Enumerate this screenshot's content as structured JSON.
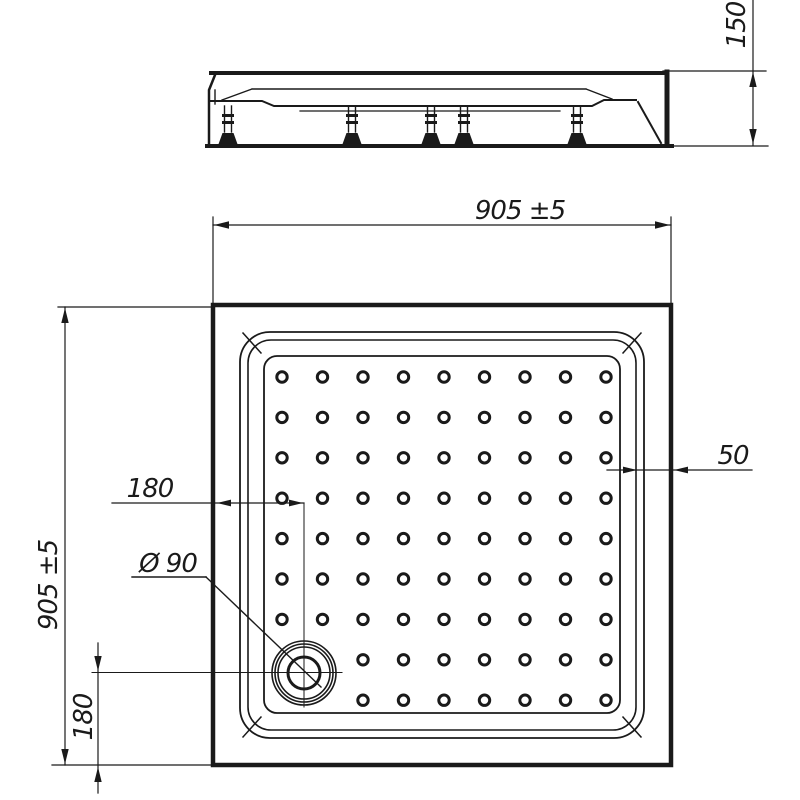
{
  "document": {
    "type": "technical-drawing",
    "subject": "square shower tray with adjustable feet",
    "background": "#ffffff",
    "line_color": "#1a1a1a"
  },
  "labels": {
    "overall_width": "905 ±5",
    "overall_depth": "905 ±5",
    "tray_height": "150",
    "flange_width": "50",
    "drain_offset_left": "180",
    "drain_offset_bottom": "180",
    "drain_diameter": "Ø 90"
  },
  "pattern": {
    "name": "anti-slip-dot-grid",
    "rows": 9,
    "cols": 9,
    "start_x": 282,
    "start_y": 377,
    "spacing_x": 40.5,
    "spacing_y": 40.4,
    "dot_radius": 5.2,
    "skip": [
      [
        7,
        0
      ],
      [
        7,
        1
      ],
      [
        8,
        0
      ],
      [
        8,
        1
      ]
    ]
  },
  "drain": {
    "cx": 304,
    "cy": 673,
    "radii": [
      32,
      29,
      26,
      16
    ]
  },
  "side_view": {
    "feet_x": [
      228,
      352,
      431,
      464,
      577
    ]
  }
}
